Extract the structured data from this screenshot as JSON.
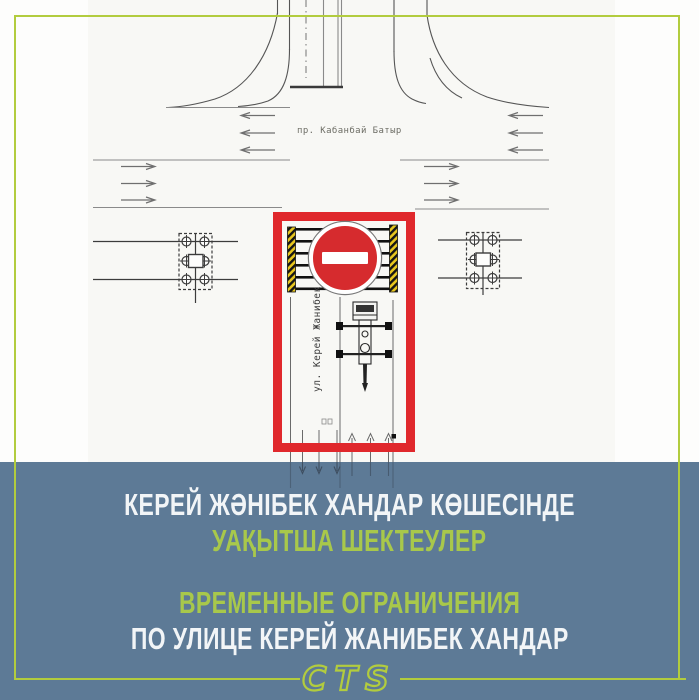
{
  "theme": {
    "accent": "#b2cc3e",
    "banner": "#5d7a96",
    "alert": "#e0282c",
    "sign": "#d62b2e",
    "text_green": "#a8c84b",
    "text_white": "#f2f5f7"
  },
  "diagram": {
    "avenue_label": "пр. Кабанбай Батыр",
    "street_label": "ул. Керей Жанибек хандар"
  },
  "banner": {
    "title_kz_line1": "КЕРЕЙ ЖӘНІБЕК ХАНДАР КӨШЕСІНДЕ",
    "title_kz_line2": "УАҚЫТША ШЕКТЕУЛЕР",
    "title_ru_line1": "ВРЕМЕННЫЕ ОГРАНИЧЕНИЯ",
    "title_ru_line2": "ПО УЛИЦЕ КЕРЕЙ ЖАНИБЕК ХАНДАР"
  },
  "footer": {
    "logo": "CTS"
  }
}
